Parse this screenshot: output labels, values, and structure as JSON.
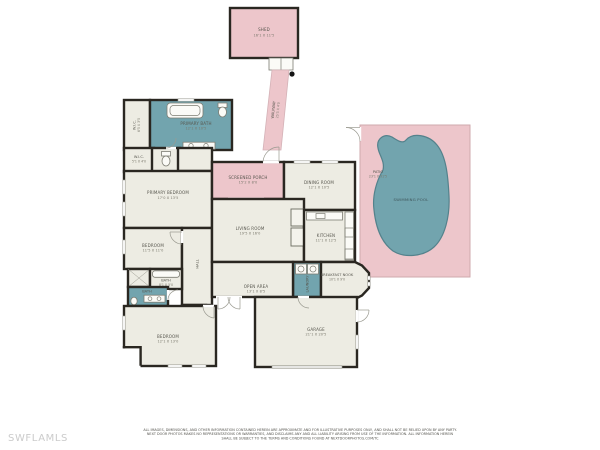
{
  "canvas": {
    "width": 600,
    "height": 450,
    "background": "#ffffff"
  },
  "colors": {
    "outdoor_pink": "#edc6cb",
    "wet_room_teal": "#72a4ae",
    "pool_water": "#72a4ae",
    "room_fill": "#edece3",
    "wall": "#2a2721",
    "label_text": "#57564e",
    "dims_text": "#7a786c",
    "watermark_gray": "#cbcbcb"
  },
  "watermark": "SWFLAMLS",
  "outdoor": {
    "shed": {
      "name": "SHED",
      "dims": "16'1 X 11'5"
    },
    "walkway": {
      "name": "WALKWAY",
      "dims": "25'5 X 4'0"
    },
    "patio": {
      "name": "PATIO",
      "dims": "23'1 X 31'5"
    },
    "pool": {
      "name": "SWIMMING POOL"
    }
  },
  "rooms": {
    "primary_bath": {
      "name": "PRIMARY BATH",
      "dims": "12'1 X 10'5"
    },
    "wic_primary": {
      "name": "W.I.C.",
      "dims": "6'5 X 3'5"
    },
    "wic_small": {
      "name": "W.I.C.",
      "dims": "5'1 X 4'0"
    },
    "primary_bedroom": {
      "name": "PRIMARY BEDROOM",
      "dims": "17'0 X 13'5"
    },
    "bedroom_2": {
      "name": "BEDROOM",
      "dims": "11'5 X 11'0"
    },
    "hall": {
      "name": "HALL"
    },
    "screened_porch": {
      "name": "SCREENED PORCH",
      "dims": "15'2 X 8'0"
    },
    "dining_room": {
      "name": "DINING ROOM",
      "dims": "12'1 X 10'5"
    },
    "living_room": {
      "name": "LIVING ROOM",
      "dims": "19'5 X 16'0"
    },
    "kitchen": {
      "name": "KITCHEN",
      "dims": "11'1 X 12'5"
    },
    "laundry": {
      "name": "LAUNDRY"
    },
    "breakfast_nook": {
      "name": "BREAKFAST NOOK",
      "dims": "10'1 X 9'0"
    },
    "open_area": {
      "name": "OPEN AREA",
      "dims": "13'1 X 8'5"
    },
    "garage": {
      "name": "GARAGE",
      "dims": "21'1 X 20'5"
    },
    "bath_2": {
      "name": "BATH",
      "dims": "8'1 X 5'0"
    },
    "bath_3": {
      "name": "BATH",
      "dims": "9'1 X 5'0"
    },
    "wic_2": {
      "name": "W.I.C.",
      "dims": "5'0 X 5'0"
    },
    "bedroom_3": {
      "name": "BEDROOM",
      "dims": "12'1 X 13'0"
    }
  },
  "disclaimer": {
    "line1": "ALL IMAGES, DIMENSIONS, AND OTHER INFORMATION CONTAINED HEREIN ARE APPROXIMATE AND FOR ILLUSTRATIVE PURPOSES ONLY, AND SHALL NOT BE RELIED UPON BY ANY PARTY.",
    "line2": "NEXT DOOR PHOTOS MAKES NO REPRESENTATIONS OR WARRANTIES, AND DISCLAIMS ANY AND ALL LIABILITY ARISING FROM USE OF THE INFORMATION. ALL INFORMATION HEREIN",
    "line3": "SHALL BE SUBJECT TO THE TERMS AND CONDITIONS FOUND AT NEXTDOORPHOTOS.COM/TC"
  }
}
